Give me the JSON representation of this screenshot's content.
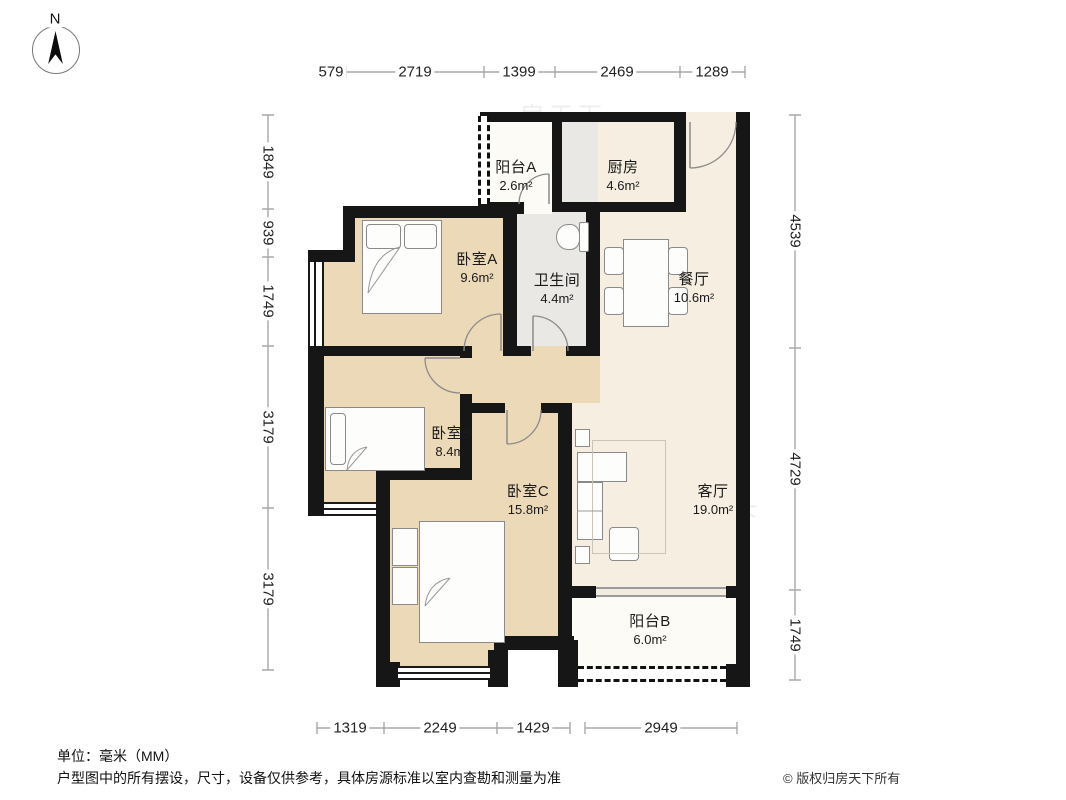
{
  "north_label": "N",
  "watermark": "房天下",
  "dimensions": {
    "top": [
      "579",
      "2719",
      "1399",
      "2469",
      "1289"
    ],
    "left": [
      "1849",
      "939",
      "1749",
      "3179",
      "3179"
    ],
    "right": [
      "4539",
      "4729",
      "1749"
    ],
    "bottom": [
      "1319",
      "2249",
      "1429",
      "2949"
    ]
  },
  "rooms": {
    "balcony_a": {
      "name": "阳台A",
      "area": "2.6m²"
    },
    "kitchen": {
      "name": "厨房",
      "area": "4.6m²"
    },
    "bedroom_a": {
      "name": "卧室A",
      "area": "9.6m²"
    },
    "bathroom": {
      "name": "卫生间",
      "area": "4.4m²"
    },
    "dining": {
      "name": "餐厅",
      "area": "10.6m²"
    },
    "bedroom_b": {
      "name": "卧室B",
      "area": "8.4m²"
    },
    "bedroom_c": {
      "name": "卧室C",
      "area": "15.8m²"
    },
    "living": {
      "name": "客厅",
      "area": "19.0m²"
    },
    "balcony_b": {
      "name": "阳台B",
      "area": "6.0m²"
    }
  },
  "footer": {
    "unit": "单位：毫米（MM）",
    "disclaimer": "户型图中的所有摆设，尺寸，设备仅供参考，具体房源标准以室内查勘和测量为准",
    "copyright": "© 版权归房天下所有"
  },
  "colors": {
    "wall": "#161616",
    "bedroom_floor": "#ecd9b8",
    "living_floor": "#f6efe1",
    "wet_floor": "#e9e8e5",
    "balcony_floor": "#fcfbf5"
  }
}
